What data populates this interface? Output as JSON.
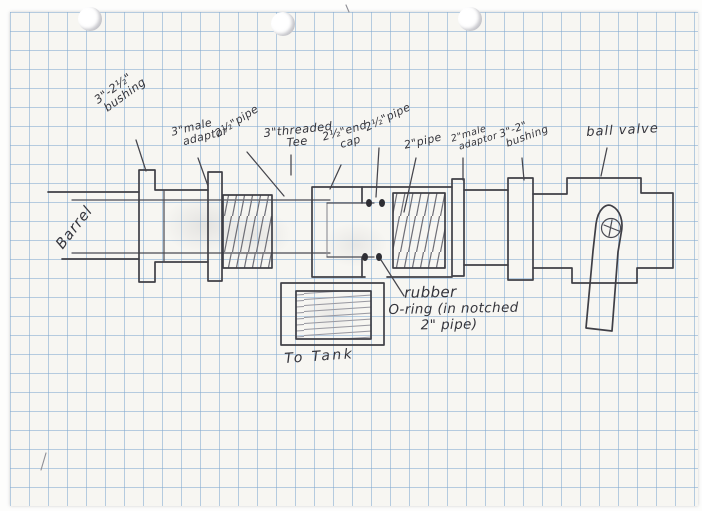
{
  "figure": {
    "kind": "hand-drawn pipe-assembly schematic on graph paper",
    "colors": {
      "paper": "#f7f6f2",
      "grid_blue": "#80a8d0",
      "ink": "#3f3f46",
      "pencil": "#8d8d94"
    }
  },
  "labels": {
    "bushing_a": {
      "line1": "3\"-2½\"",
      "line2": "bushing"
    },
    "adaptor_a": {
      "line1": "3\"male",
      "line2": "adaptor"
    },
    "pipe_a": {
      "line1": "2½\"pipe"
    },
    "tee": {
      "line1": "3\"threaded",
      "line2": "Tee"
    },
    "end_cap": {
      "line1": "2½\"end",
      "line2": "cap"
    },
    "pipe_b": {
      "line1": "2½\"pipe"
    },
    "pipe_c": {
      "line1": "2\"pipe"
    },
    "adaptor_b": {
      "line1": "2\"male",
      "line2": "adaptor"
    },
    "bushing_b": {
      "line1": "3\"-2\"",
      "line2": "bushing"
    },
    "ball_valve": {
      "line1": "ball valve"
    },
    "barrel": {
      "line1": "Barrel"
    },
    "to_tank": {
      "line1": "To Tank"
    },
    "o_ring_note": {
      "line1": "rubber",
      "line2": "O-ring (in notched",
      "line3": "2\" pipe)"
    }
  }
}
